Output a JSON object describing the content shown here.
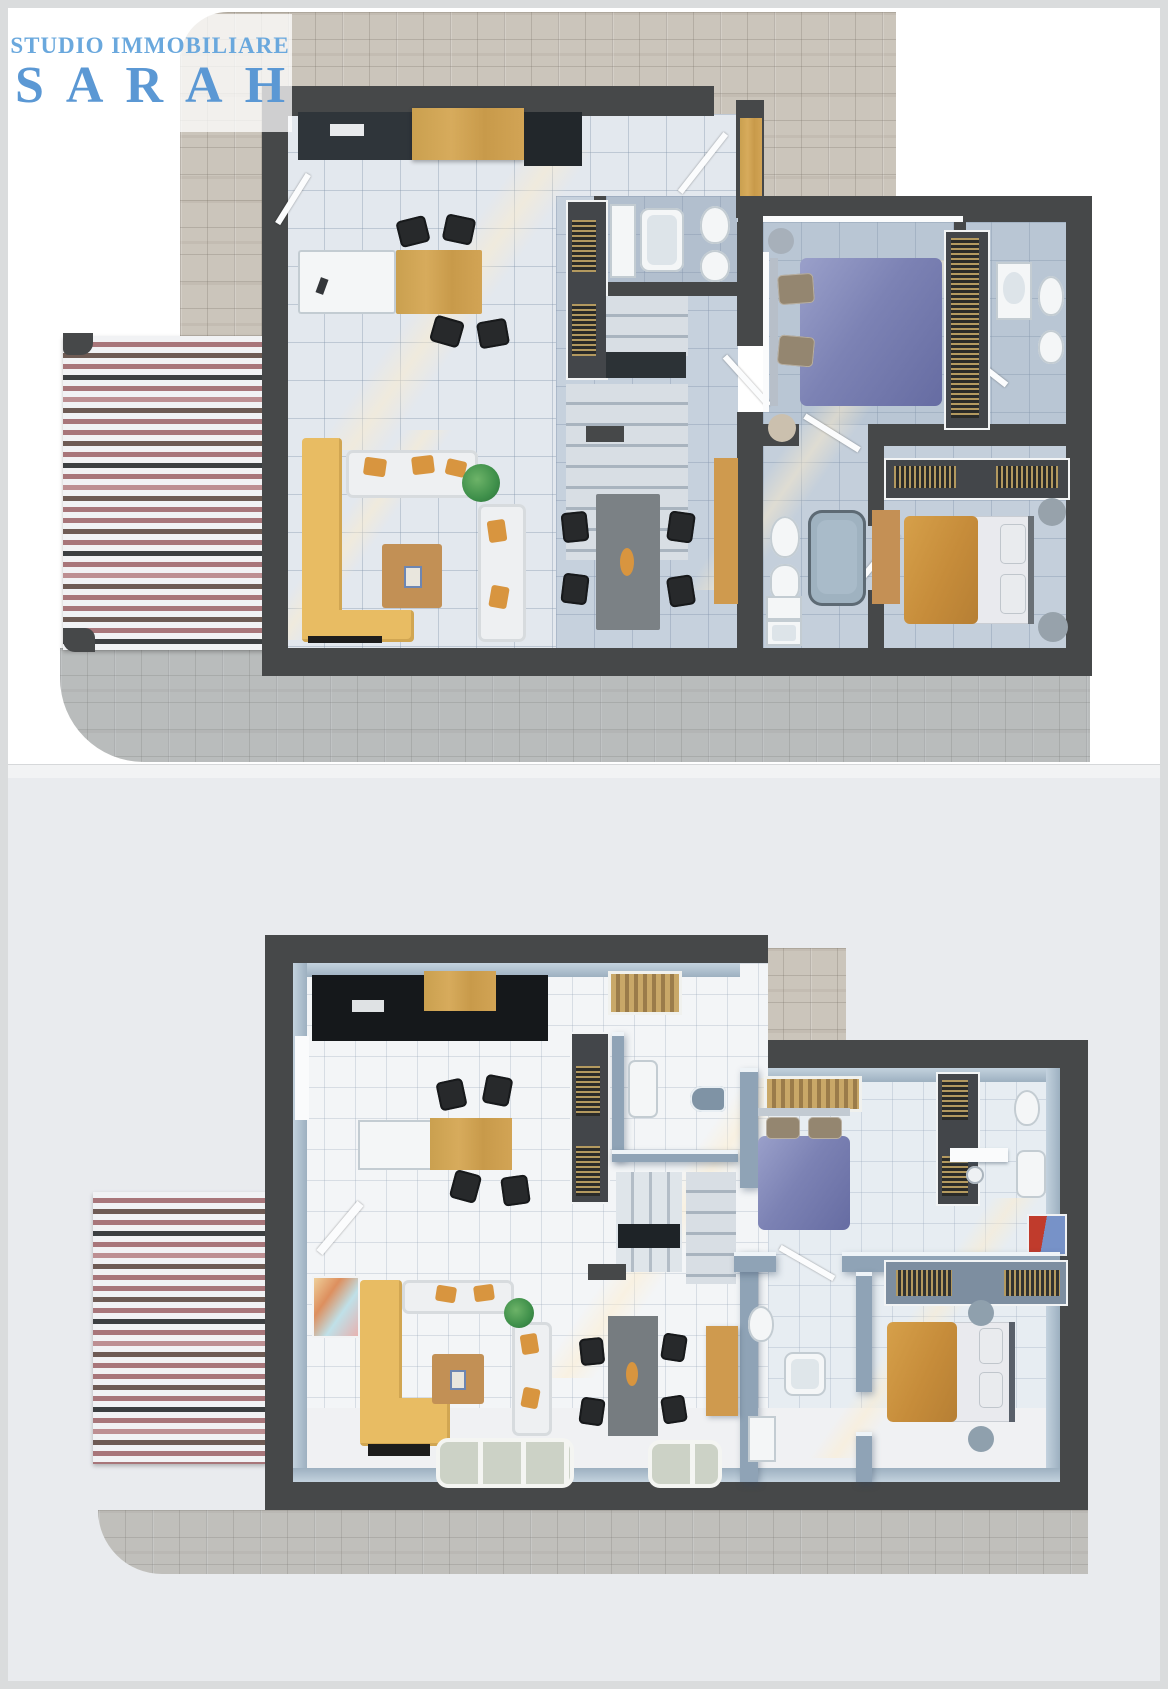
{
  "watermark": {
    "line1": "STUDIO IMMOBILIARE",
    "line2": "SARAH"
  },
  "panels": {
    "top": {
      "view": "2d-top-down-floor-plan"
    },
    "bottom": {
      "view": "3d-dollhouse-floor-plan"
    }
  },
  "colors": {
    "brand1": "#6aa8dd",
    "brand2": "#5b98d4",
    "frame": "#dadcdd",
    "wall": "#464849",
    "wall3d": "#8fa3b6",
    "paving": "#cbc5bb",
    "pavingBlue": "#b9c2c9",
    "floor1": "#e3e8ee",
    "floorHall": "#c6d1dd",
    "floorBed": "#b9c6d4",
    "bg2": "#e9ebee",
    "floor2": "#f3f5f7",
    "awnWhite": "#f1f2f4",
    "awnRose": "#a8767a",
    "awnRose2": "#bd8f92",
    "awnBrown": "#6e5b54",
    "awnDark": "#3c3f41",
    "sofaYellow": "#e8bc63",
    "sofaWhite": "#eef0f2",
    "cushion": "#d8953f",
    "wood": "#d2a055",
    "counter": "#2f353a",
    "chair": "#27292b",
    "bedBlue": "#7c82b4",
    "bedOrange": "#c68c3a",
    "sheet": "#e9eaee",
    "slat": "#b3995f",
    "tableGray": "#7b8185",
    "tub": "#9fb2c0",
    "glass": "#ccd2c6",
    "plant": "#3e8f4a"
  }
}
